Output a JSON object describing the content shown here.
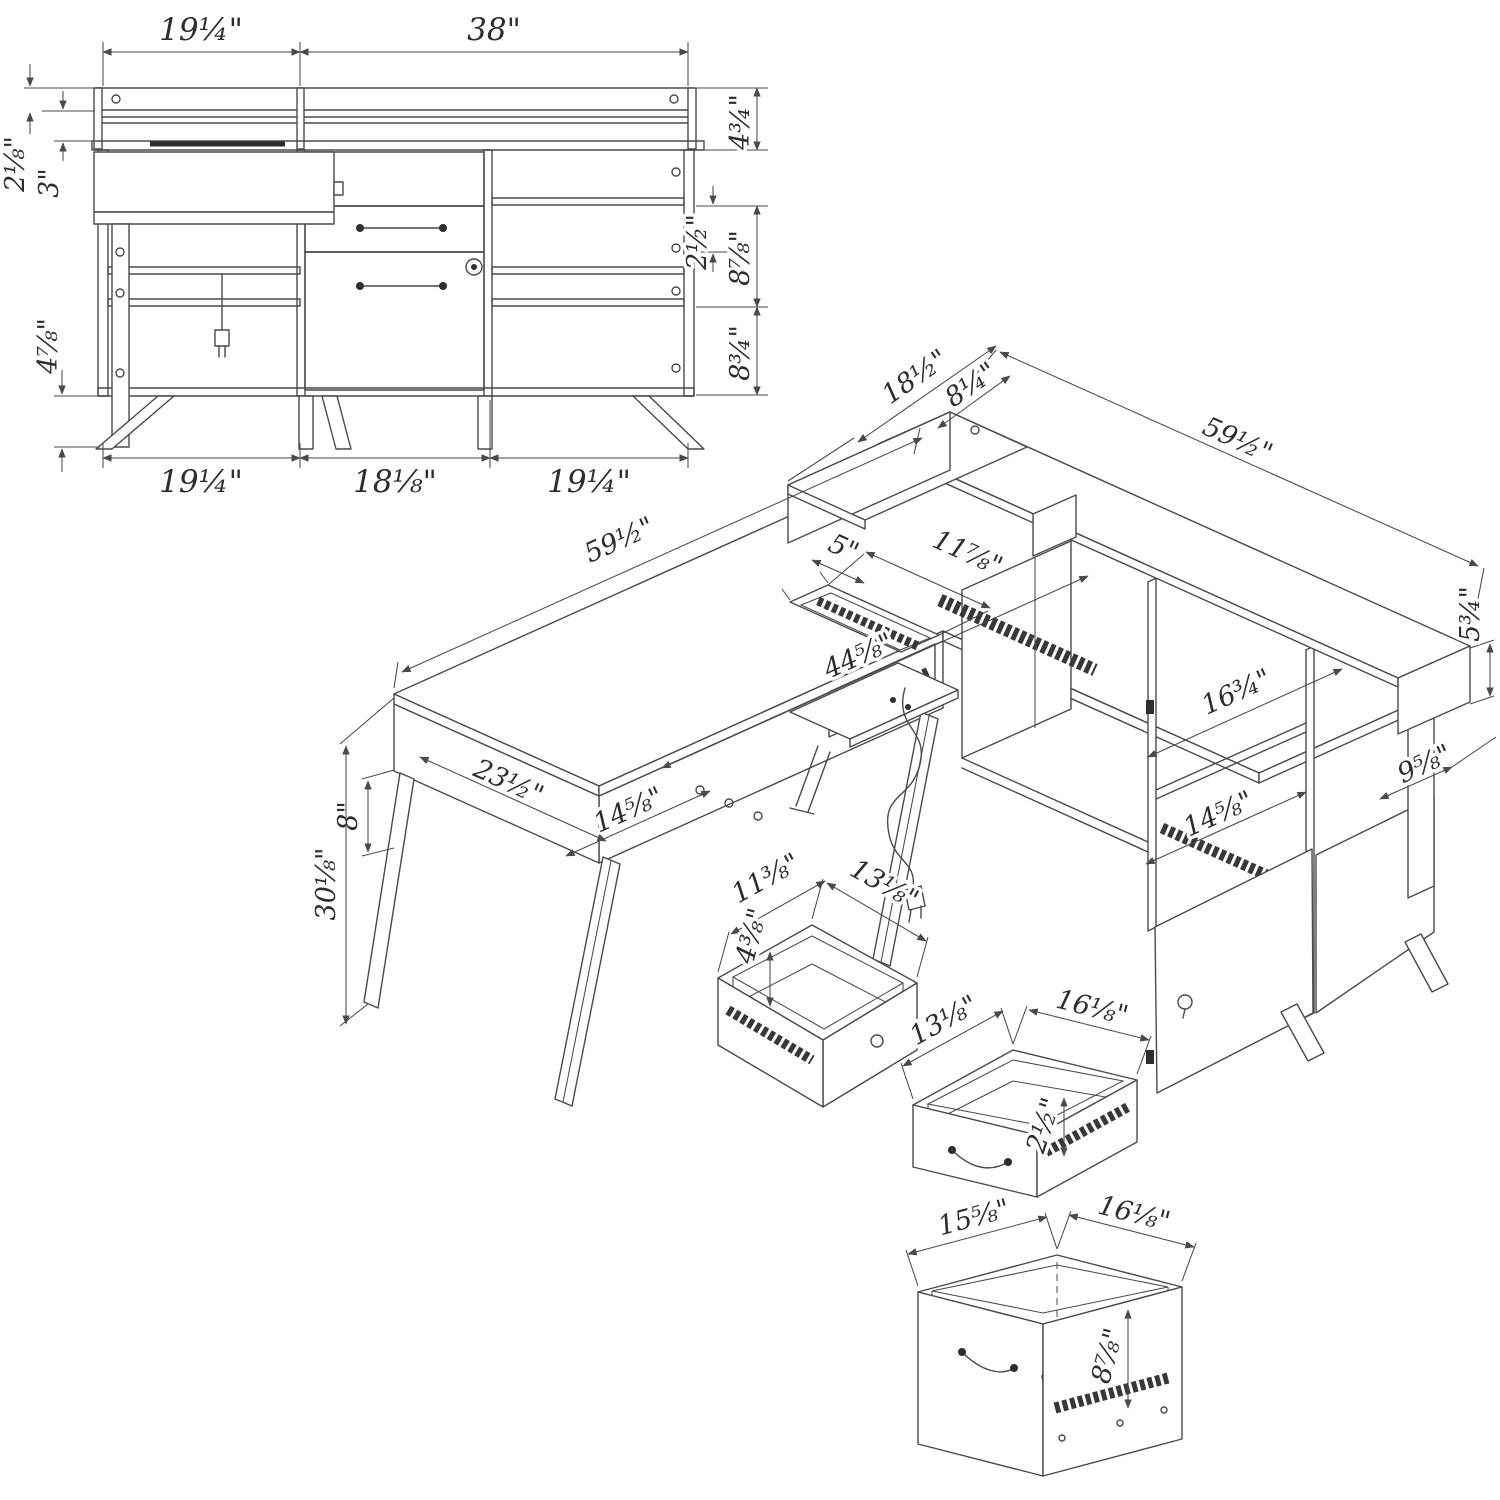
{
  "style": {
    "ink": "#4a4a4a",
    "paper": "#ffffff"
  },
  "elevation": {
    "top_width_left": "19¼\"",
    "top_width_right": "38\"",
    "rail_board_height": "2⅛\"",
    "rail_gap_height": "3\"",
    "leg_clearance": "4⅞\"",
    "hutch_rail_height": "4¾\"",
    "small_drawer_height": "2½\"",
    "middle_section_height": "8⅞\"",
    "lower_section_height": "8¾\"",
    "bottom_width_left": "19¼\"",
    "bottom_width_center": "18⅛\"",
    "bottom_width_right": "19¼\""
  },
  "isometric": {
    "riser_return_depth": "18½\"",
    "riser_shelf_depth": "8¼\"",
    "riser_length": "59½\"",
    "riser_end_height": "5¾\"",
    "return_length": "59½\"",
    "grommet_width": "5\"",
    "grommet_length": "11⅞\"",
    "desk_span": "44⅝\"",
    "return_depth": "23½\"",
    "return_cubby_width": "14⅝\"",
    "apron_height": "8\"",
    "total_height": "30⅛\"",
    "center_opening_width": "16¾\"",
    "right_cubby_width": "14⅝\"",
    "end_shelf_depth": "9⅝\""
  },
  "drawers": {
    "small": {
      "depth": "11⅜\"",
      "width": "13⅛\"",
      "height": "4⅜\""
    },
    "center": {
      "depth": "13⅛\"",
      "width": "16⅛\"",
      "height": "2½\""
    },
    "file": {
      "depth": "15⅝\"",
      "width": "16⅛\"",
      "height": "8⅞\""
    }
  }
}
